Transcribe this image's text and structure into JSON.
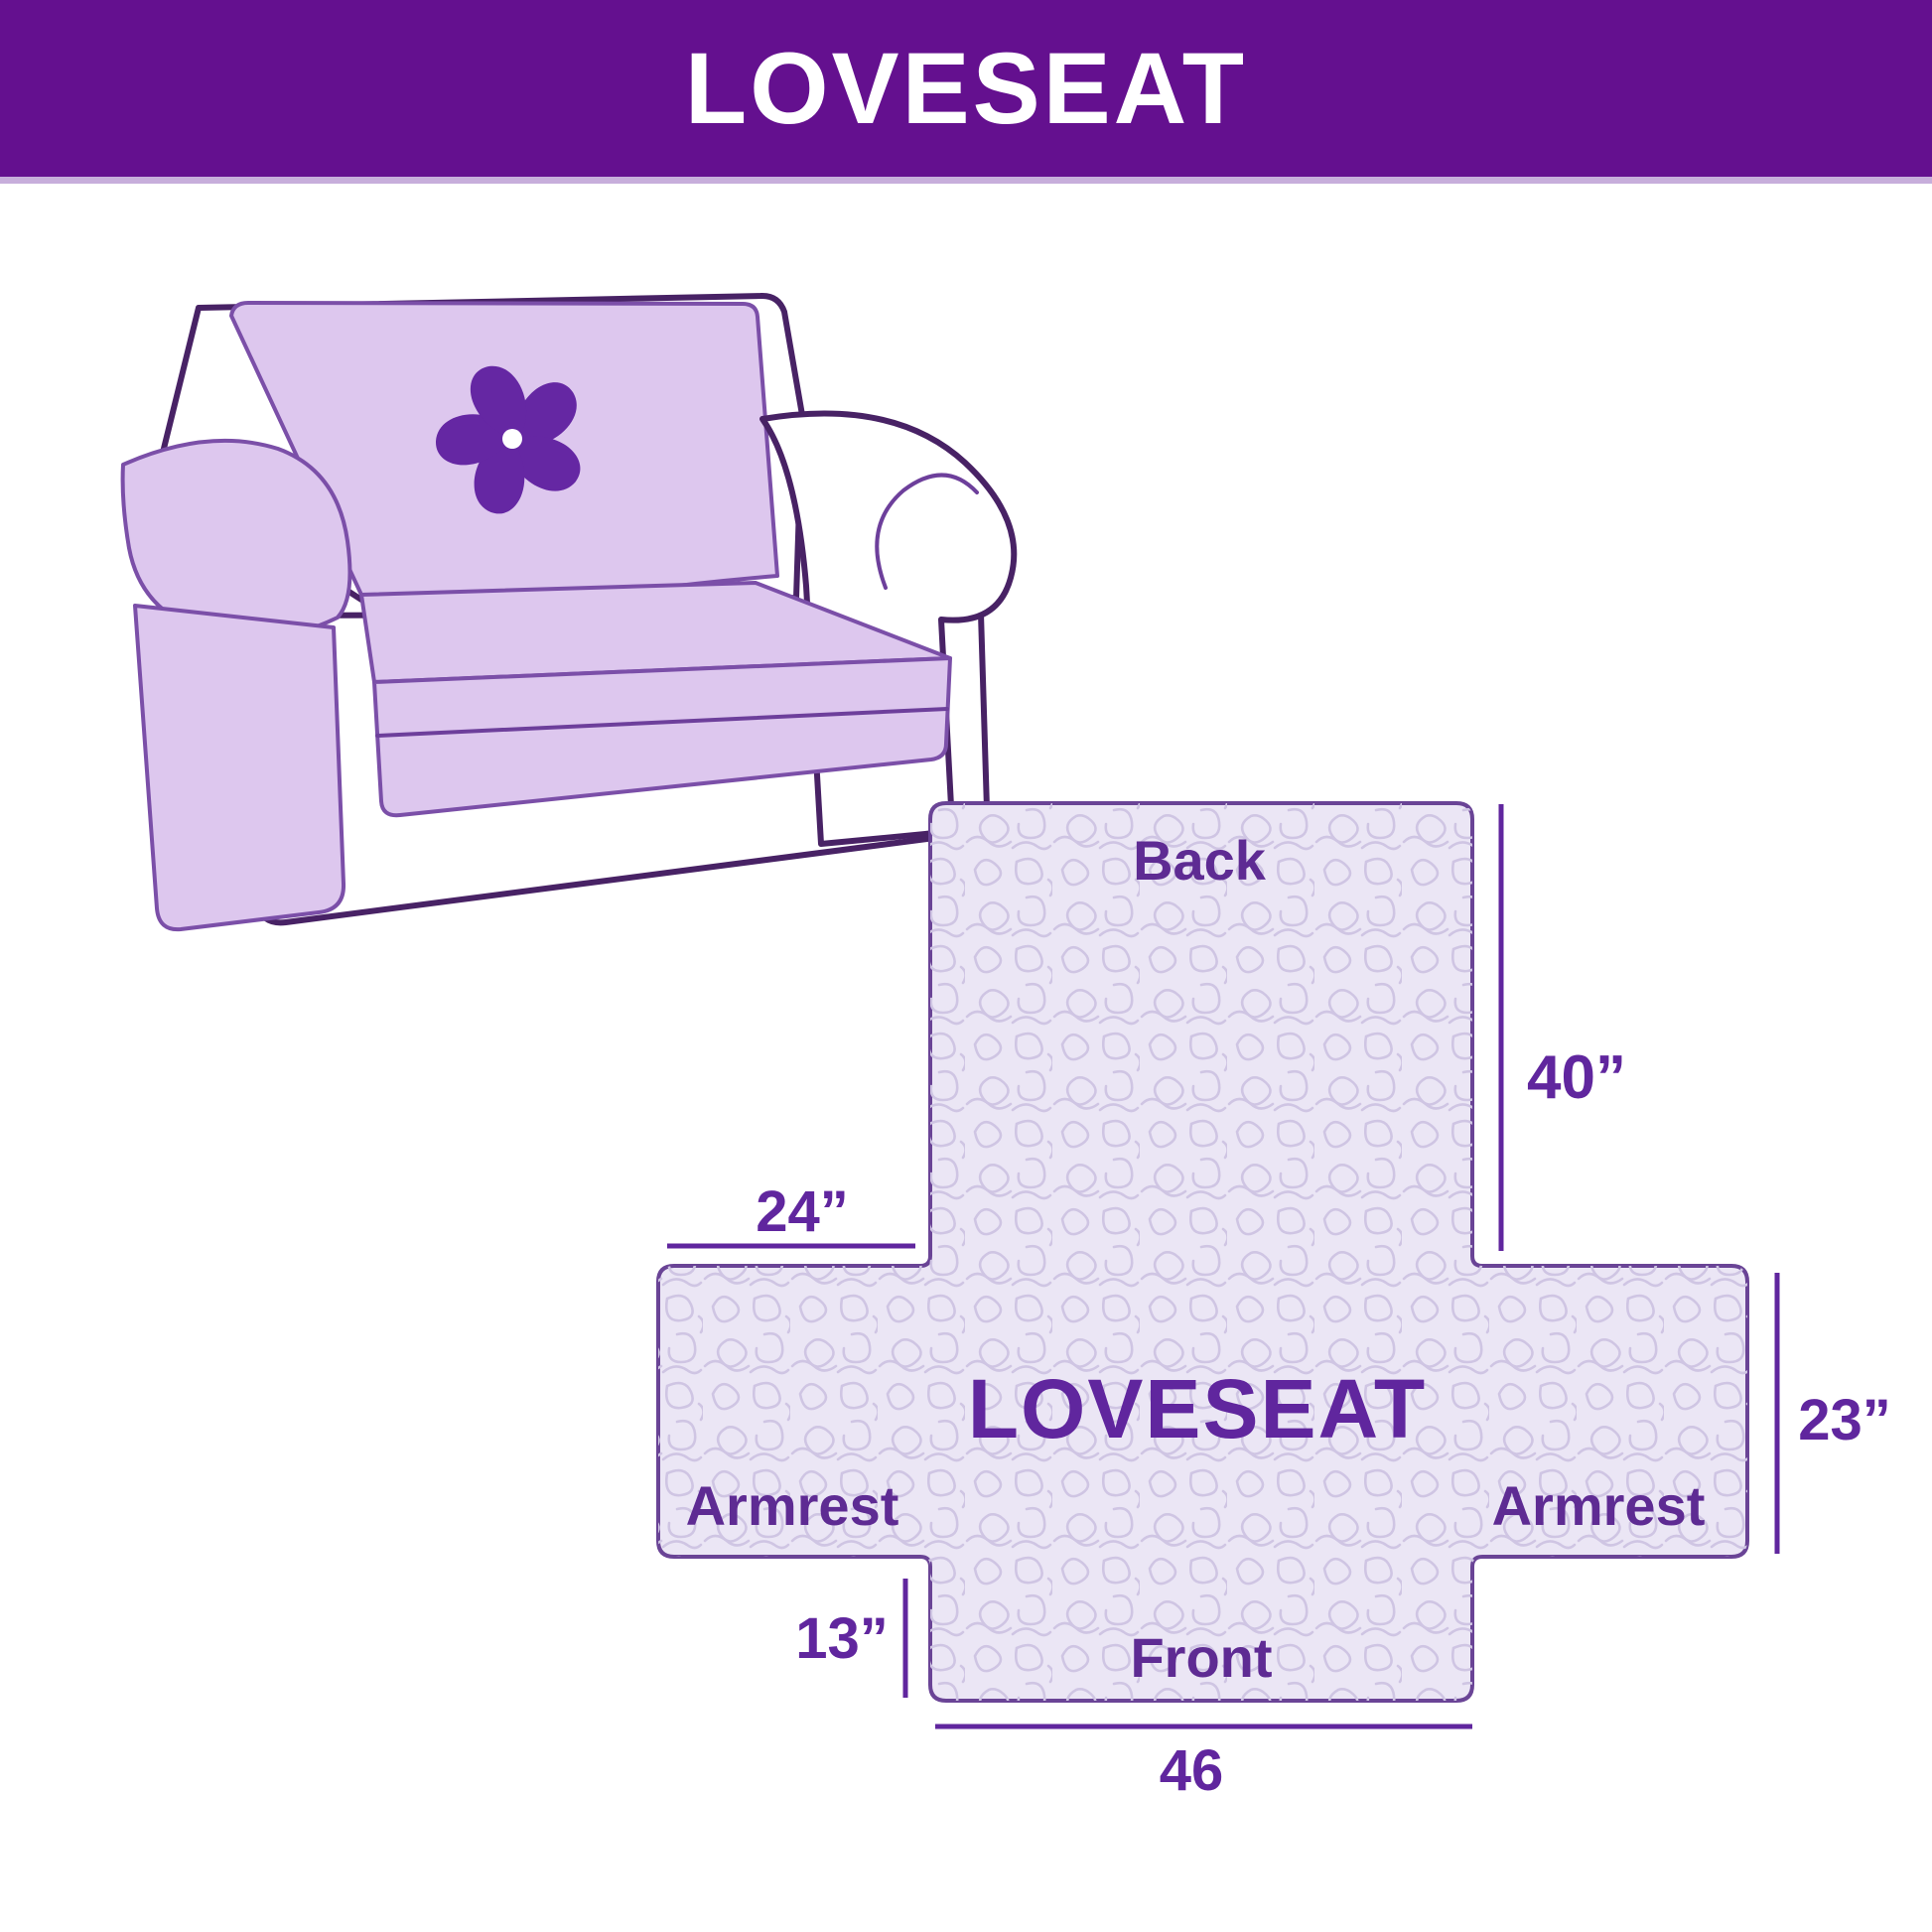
{
  "header": {
    "title": "LOVESEAT"
  },
  "illustration": {
    "subject": "loveseat-sofa-with-quilted-cover",
    "logo": "pinwheel-flower"
  },
  "diagram": {
    "center_label": "LOVESEAT",
    "back_label": "Back",
    "front_label": "Front",
    "armrest_left_label": "Armrest",
    "armrest_right_label": "Armrest",
    "dim_back_height": "40”",
    "dim_armrest_top_width": "24”",
    "dim_armrest_side_height": "23”",
    "dim_front_drop": "13”",
    "dim_front_width": "46"
  },
  "colors": {
    "header_bg": "#64108f",
    "accent_line": "#c7aedb",
    "dimension": "#60269e",
    "cover_fill": "#ddc7ee",
    "quilt_bg": "#ebe6f5",
    "quilt_line": "#cfc5e3",
    "sofa_outline": "#482265",
    "logo_purple": "#6527a3",
    "diagram_border": "#6a4496"
  }
}
